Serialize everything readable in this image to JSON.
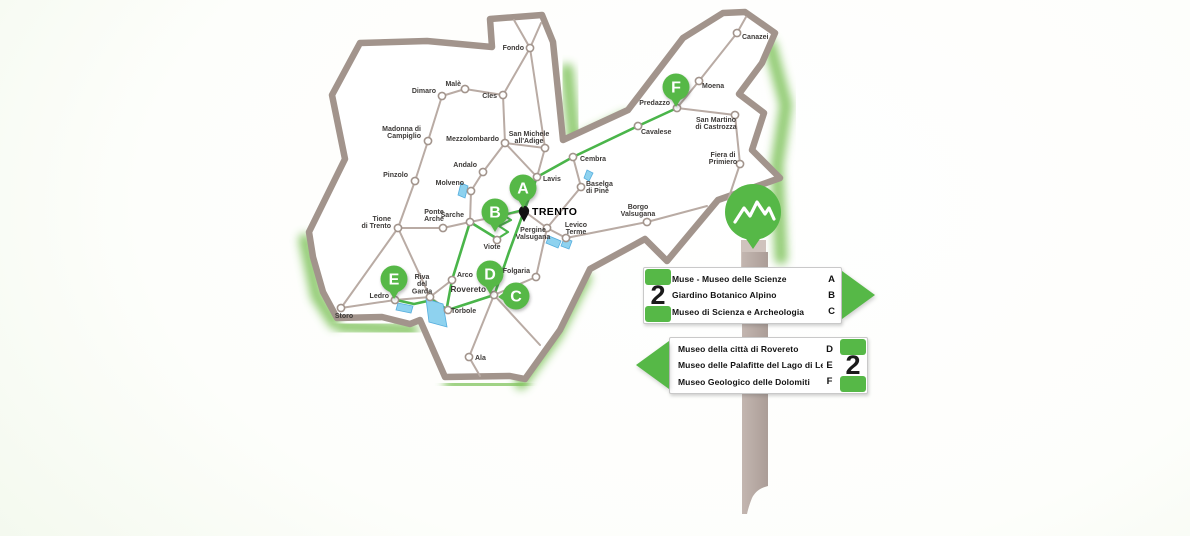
{
  "palette": {
    "green": "#56b847",
    "route_green": "#4ab54a",
    "glow_green": "#7ec25a",
    "border": "#a2948c",
    "road": "#b9aba4",
    "lake_fill": "#8ed2ef",
    "lake_stroke": "#56aede",
    "label_text": "#3d3a38",
    "pole": "#b7a9a3",
    "pole_light": "#cfc3bd",
    "region_fill": "#ffffff"
  },
  "map": {
    "capital": {
      "name": "TRENTO",
      "x": 524,
      "y": 211,
      "lx": 532,
      "ly": 215
    },
    "towns": [
      {
        "name": "Fondo",
        "lines": [
          "Fondo"
        ],
        "x": 530,
        "y": 48,
        "lx": 524,
        "ly": 50,
        "anchor": "end"
      },
      {
        "name": "Malè",
        "lines": [
          "Malè"
        ],
        "x": 465,
        "y": 89,
        "lx": 461,
        "ly": 86,
        "anchor": "end"
      },
      {
        "name": "Dimaro",
        "lines": [
          "Dimaro"
        ],
        "x": 442,
        "y": 96,
        "lx": 436,
        "ly": 93,
        "anchor": "end"
      },
      {
        "name": "Cles",
        "lines": [
          "Cles"
        ],
        "x": 503,
        "y": 95,
        "lx": 497,
        "ly": 98,
        "anchor": "end"
      },
      {
        "name": "Madonna di Campiglio",
        "lines": [
          "Madonna di",
          "Campiglio"
        ],
        "x": 428,
        "y": 141,
        "lx": 421,
        "ly": 131,
        "anchor": "end"
      },
      {
        "name": "Mezzolombardo",
        "lines": [
          "Mezzolombardo"
        ],
        "x": 505,
        "y": 143,
        "lx": 499,
        "ly": 141,
        "anchor": "end"
      },
      {
        "name": "San Michele all'Adige",
        "lines": [
          "San Michele",
          "all'Adige"
        ],
        "x": 545,
        "y": 148,
        "lx": 529,
        "ly": 136,
        "anchor": "middle"
      },
      {
        "name": "Pinzolo",
        "lines": [
          "Pinzolo"
        ],
        "x": 415,
        "y": 181,
        "lx": 408,
        "ly": 177,
        "anchor": "end"
      },
      {
        "name": "Andalo",
        "lines": [
          "Andalo"
        ],
        "x": 483,
        "y": 172,
        "lx": 477,
        "ly": 167,
        "anchor": "end"
      },
      {
        "name": "Molveno",
        "lines": [
          "Molveno"
        ],
        "x": 471,
        "y": 191,
        "lx": 464,
        "ly": 185,
        "anchor": "end"
      },
      {
        "name": "Lavis",
        "lines": [
          "Lavis"
        ],
        "x": 537,
        "y": 177,
        "lx": 543,
        "ly": 181,
        "anchor": "start"
      },
      {
        "name": "Cembra",
        "lines": [
          "Cembra"
        ],
        "x": 573,
        "y": 157,
        "lx": 580,
        "ly": 161,
        "anchor": "start"
      },
      {
        "name": "Baselga di Pinè",
        "lines": [
          "Baselga",
          "di Pinè"
        ],
        "x": 581,
        "y": 187,
        "lx": 586,
        "ly": 186,
        "anchor": "start"
      },
      {
        "name": "Tione di Trento",
        "lines": [
          "Tione",
          "di Trento"
        ],
        "x": 398,
        "y": 228,
        "lx": 391,
        "ly": 221,
        "anchor": "end"
      },
      {
        "name": "Ponte Arche",
        "lines": [
          "Ponte",
          "Arche"
        ],
        "x": 443,
        "y": 228,
        "lx": 434,
        "ly": 214,
        "anchor": "middle"
      },
      {
        "name": "Sarche",
        "lines": [
          "Sarche"
        ],
        "x": 470,
        "y": 222,
        "lx": 464,
        "ly": 217,
        "anchor": "end"
      },
      {
        "name": "Viote",
        "lines": [
          "Viote"
        ],
        "x": 497,
        "y": 240,
        "lx": 492,
        "ly": 249,
        "anchor": "middle"
      },
      {
        "name": "Pergine Valsugana",
        "lines": [
          "Pergine",
          "Valsugana"
        ],
        "x": 547,
        "y": 228,
        "lx": 533,
        "ly": 232,
        "anchor": "middle"
      },
      {
        "name": "Levico Terme",
        "lines": [
          "Levico",
          "Terme"
        ],
        "x": 566,
        "y": 238,
        "lx": 576,
        "ly": 227,
        "anchor": "middle"
      },
      {
        "name": "Borgo Valsugana",
        "lines": [
          "Borgo",
          "Valsugana"
        ],
        "x": 647,
        "y": 222,
        "lx": 638,
        "ly": 209,
        "anchor": "middle"
      },
      {
        "name": "Folgaria",
        "lines": [
          "Folgaria"
        ],
        "x": 536,
        "y": 277,
        "lx": 530,
        "ly": 273,
        "anchor": "end"
      },
      {
        "name": "Arco",
        "lines": [
          "Arco"
        ],
        "x": 452,
        "y": 280,
        "lx": 457,
        "ly": 277,
        "anchor": "start"
      },
      {
        "name": "Riva del Garda",
        "lines": [
          "Riva",
          "del",
          "Garda"
        ],
        "x": 430,
        "y": 297,
        "lx": 422,
        "ly": 279,
        "anchor": "middle"
      },
      {
        "name": "Rovereto",
        "lines": [
          "Rovereto"
        ],
        "x": 494,
        "y": 295,
        "lx": 486,
        "ly": 292,
        "anchor": "end",
        "emphasis": true
      },
      {
        "name": "Torbole",
        "lines": [
          "Torbole"
        ],
        "x": 448,
        "y": 310,
        "lx": 451,
        "ly": 313,
        "anchor": "start"
      },
      {
        "name": "Ledro",
        "lines": [
          "Ledro"
        ],
        "x": 395,
        "y": 300,
        "lx": 389,
        "ly": 298,
        "anchor": "end"
      },
      {
        "name": "Storo",
        "lines": [
          "Storo"
        ],
        "x": 341,
        "y": 308,
        "lx": 344,
        "ly": 318,
        "anchor": "middle"
      },
      {
        "name": "Ala",
        "lines": [
          "Ala"
        ],
        "x": 469,
        "y": 357,
        "lx": 475,
        "ly": 360,
        "anchor": "start"
      },
      {
        "name": "Canazei",
        "lines": [
          "Canazei"
        ],
        "x": 737,
        "y": 33,
        "lx": 742,
        "ly": 39,
        "anchor": "start"
      },
      {
        "name": "Moena",
        "lines": [
          "Moena"
        ],
        "x": 699,
        "y": 81,
        "lx": 702,
        "ly": 88,
        "anchor": "start"
      },
      {
        "name": "Predazzo",
        "lines": [
          "Predazzo"
        ],
        "x": 677,
        "y": 108,
        "lx": 670,
        "ly": 105,
        "anchor": "end"
      },
      {
        "name": "Cavalese",
        "lines": [
          "Cavalese"
        ],
        "x": 638,
        "y": 126,
        "lx": 641,
        "ly": 134,
        "anchor": "start"
      },
      {
        "name": "San Martino di Castrozza",
        "lines": [
          "San Martino",
          "di Castrozza"
        ],
        "x": 735,
        "y": 115,
        "lx": 716,
        "ly": 122,
        "anchor": "middle"
      },
      {
        "name": "Fiera di Primiero",
        "lines": [
          "Fiera di",
          "Primiero"
        ],
        "x": 740,
        "y": 164,
        "lx": 723,
        "ly": 157,
        "anchor": "middle"
      }
    ],
    "outline": [
      [
        360,
        43
      ],
      [
        427,
        41
      ],
      [
        492,
        47
      ],
      [
        490,
        19
      ],
      [
        542,
        15
      ],
      [
        553,
        42
      ],
      [
        563,
        140
      ],
      [
        628,
        110
      ],
      [
        683,
        38
      ],
      [
        723,
        13
      ],
      [
        745,
        12
      ],
      [
        775,
        33
      ],
      [
        762,
        63
      ],
      [
        739,
        94
      ],
      [
        764,
        113
      ],
      [
        752,
        150
      ],
      [
        780,
        178
      ],
      [
        718,
        200
      ],
      [
        667,
        261
      ],
      [
        645,
        239
      ],
      [
        590,
        269
      ],
      [
        560,
        330
      ],
      [
        525,
        379
      ],
      [
        510,
        376
      ],
      [
        445,
        377
      ],
      [
        420,
        320
      ],
      [
        410,
        324
      ],
      [
        382,
        317
      ],
      [
        337,
        318
      ],
      [
        323,
        292
      ],
      [
        313,
        257
      ],
      [
        309,
        232
      ],
      [
        345,
        159
      ],
      [
        332,
        95
      ]
    ],
    "glow_strips": [
      [
        [
          567,
          70
        ],
        [
          574,
          138
        ]
      ],
      [
        [
          577,
          142
        ],
        [
          626,
          118
        ]
      ],
      [
        [
          770,
          45
        ],
        [
          786,
          105
        ],
        [
          777,
          165
        ],
        [
          781,
          258
        ]
      ],
      [
        [
          585,
          278
        ],
        [
          556,
          335
        ],
        [
          521,
          383
        ]
      ],
      [
        [
          450,
          384
        ],
        [
          522,
          385
        ]
      ],
      [
        [
          342,
          326
        ],
        [
          412,
          330
        ]
      ],
      [
        [
          305,
          240
        ],
        [
          317,
          296
        ],
        [
          334,
          322
        ]
      ]
    ],
    "roads": [
      [
        442,
        96,
        465,
        89
      ],
      [
        465,
        89,
        503,
        95
      ],
      [
        503,
        95,
        530,
        48
      ],
      [
        530,
        48,
        514,
        20
      ],
      [
        530,
        48,
        541,
        23
      ],
      [
        530,
        48,
        545,
        148
      ],
      [
        428,
        141,
        442,
        96
      ],
      [
        428,
        141,
        415,
        181
      ],
      [
        415,
        181,
        398,
        228
      ],
      [
        398,
        228,
        341,
        308
      ],
      [
        398,
        228,
        443,
        228
      ],
      [
        443,
        228,
        470,
        222
      ],
      [
        470,
        222,
        524,
        211
      ],
      [
        398,
        228,
        430,
        297
      ],
      [
        341,
        308,
        395,
        300
      ],
      [
        395,
        300,
        430,
        297
      ],
      [
        430,
        297,
        452,
        280
      ],
      [
        452,
        280,
        470,
        222
      ],
      [
        448,
        310,
        430,
        297
      ],
      [
        448,
        310,
        494,
        295
      ],
      [
        494,
        295,
        469,
        357
      ],
      [
        469,
        357,
        480,
        376
      ],
      [
        494,
        295,
        536,
        277
      ],
      [
        536,
        277,
        547,
        228
      ],
      [
        524,
        211,
        537,
        177
      ],
      [
        537,
        177,
        505,
        143
      ],
      [
        505,
        143,
        545,
        148
      ],
      [
        545,
        148,
        537,
        177
      ],
      [
        505,
        143,
        503,
        95
      ],
      [
        505,
        143,
        483,
        172
      ],
      [
        483,
        172,
        471,
        191
      ],
      [
        471,
        191,
        470,
        222
      ],
      [
        537,
        177,
        573,
        157
      ],
      [
        573,
        157,
        581,
        187
      ],
      [
        581,
        187,
        547,
        228
      ],
      [
        524,
        211,
        547,
        228
      ],
      [
        547,
        228,
        566,
        238
      ],
      [
        566,
        238,
        647,
        222
      ],
      [
        647,
        222,
        707,
        206
      ],
      [
        638,
        126,
        573,
        157
      ],
      [
        638,
        126,
        677,
        108
      ],
      [
        677,
        108,
        699,
        81
      ],
      [
        699,
        81,
        737,
        33
      ],
      [
        737,
        33,
        746,
        17
      ],
      [
        677,
        108,
        735,
        115
      ],
      [
        735,
        115,
        740,
        164
      ],
      [
        740,
        164,
        728,
        200
      ],
      [
        494,
        295,
        540,
        345
      ]
    ],
    "routes": [
      [
        [
          524,
          211
        ],
        [
          537,
          177
        ],
        [
          573,
          157
        ],
        [
          638,
          126
        ],
        [
          677,
          108
        ]
      ],
      [
        [
          524,
          211
        ],
        [
          509,
          252
        ],
        [
          495,
          293
        ]
      ],
      [
        [
          494,
          295
        ],
        [
          448,
          310
        ]
      ],
      [
        [
          448,
          310
        ],
        [
          432,
          300
        ],
        [
          414,
          304
        ],
        [
          396,
          300
        ]
      ],
      [
        [
          447,
          307
        ],
        [
          452,
          280
        ],
        [
          470,
          222
        ]
      ],
      [
        [
          470,
          222
        ],
        [
          496,
          238
        ]
      ]
    ],
    "zigzag": [
      [
        497,
        239
      ],
      [
        508,
        232
      ],
      [
        499,
        226
      ],
      [
        511,
        220
      ],
      [
        503,
        215
      ],
      [
        515,
        212
      ],
      [
        523,
        210
      ]
    ],
    "lakes": [
      [
        [
          426,
          299
        ],
        [
          443,
          304
        ],
        [
          447,
          327
        ],
        [
          429,
          322
        ]
      ],
      [
        [
          398,
          303
        ],
        [
          413,
          306
        ],
        [
          411,
          313
        ],
        [
          396,
          310
        ]
      ],
      [
        [
          461,
          183
        ],
        [
          468,
          186
        ],
        [
          465,
          198
        ],
        [
          458,
          195
        ]
      ],
      [
        [
          587,
          170
        ],
        [
          593,
          173
        ],
        [
          589,
          181
        ],
        [
          584,
          178
        ]
      ],
      [
        [
          549,
          236
        ],
        [
          561,
          241
        ],
        [
          558,
          248
        ],
        [
          546,
          243
        ]
      ],
      [
        [
          564,
          238
        ],
        [
          572,
          241
        ],
        [
          569,
          249
        ],
        [
          561,
          246
        ]
      ]
    ],
    "pins": [
      {
        "letter": "A",
        "head": [
          523,
          188
        ],
        "tip": [
          523,
          208
        ]
      },
      {
        "letter": "B",
        "head": [
          495,
          212
        ],
        "tip": [
          495,
          232
        ]
      },
      {
        "letter": "C",
        "head": [
          516,
          296
        ],
        "tip": [
          498,
          297
        ]
      },
      {
        "letter": "D",
        "head": [
          490,
          274
        ],
        "tip": [
          490,
          294
        ]
      },
      {
        "letter": "E",
        "head": [
          394,
          279
        ],
        "tip": [
          394,
          299
        ]
      },
      {
        "letter": "F",
        "head": [
          676,
          87
        ],
        "tip": [
          676,
          107
        ]
      }
    ]
  },
  "signpost": {
    "icons": {
      "ornament": "mountains-icon",
      "arrow_right": "arrow-right-icon",
      "arrow_left": "arrow-left-icon"
    },
    "signs": [
      {
        "number": "2",
        "direction": "right",
        "entries": [
          {
            "label": "Muse - Museo delle Scienze",
            "letter": "A",
            "underline": true
          },
          {
            "label": "Giardino Botanico Alpino",
            "letter": "B"
          },
          {
            "label": "Museo di Scienza e Archeologia",
            "letter": "C"
          }
        ]
      },
      {
        "number": "2",
        "direction": "left",
        "entries": [
          {
            "label": "Museo della città di Rovereto",
            "letter": "D"
          },
          {
            "label": "Museo delle Palafitte del Lago di Ledro",
            "letter": "E"
          },
          {
            "label": "Museo Geologico delle Dolomiti",
            "letter": "F"
          }
        ]
      }
    ]
  }
}
